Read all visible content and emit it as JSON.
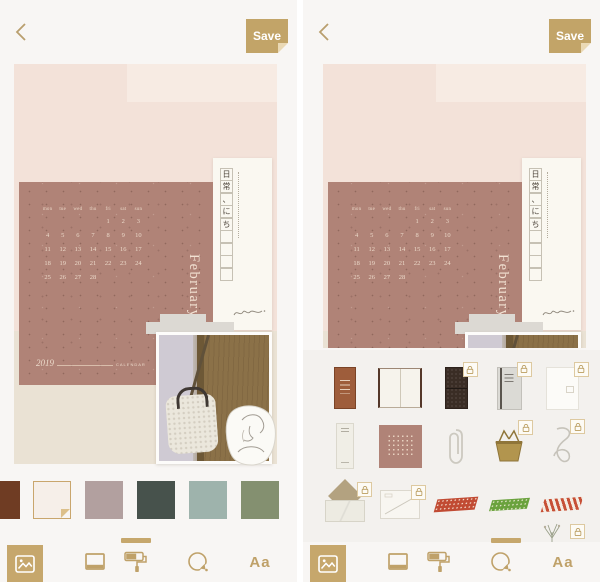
{
  "colors": {
    "accent": "#c2a468",
    "app_background": "#f8f6f4",
    "canvas_blush": "#f3e2d9",
    "canvas_cream": "#eae2d4",
    "calendar_mauve": "#b08377",
    "tray_background": "#f3f1ee"
  },
  "header": {
    "back_icon": "chevron-left",
    "save_label": "Save"
  },
  "collage": {
    "calendar": {
      "month": "February",
      "year": "2019",
      "caption": "CALENDAR",
      "day_headers": [
        "mon",
        "tue",
        "wed",
        "thu",
        "fri",
        "sat",
        "sun"
      ],
      "weeks": [
        [
          "",
          "",
          "",
          "",
          "1",
          "2",
          "3"
        ],
        [
          "4",
          "5",
          "6",
          "7",
          "8",
          "9",
          "10"
        ],
        [
          "11",
          "12",
          "13",
          "14",
          "15",
          "16",
          "17"
        ],
        [
          "18",
          "19",
          "20",
          "21",
          "22",
          "23",
          "24"
        ],
        [
          "25",
          "26",
          "27",
          "28",
          "",
          "",
          ""
        ]
      ]
    },
    "japanese_card": {
      "column_chars": [
        "日",
        "常",
        "、",
        "に",
        "ち"
      ],
      "empty_boxes": 4
    }
  },
  "left_screen": {
    "palette": {
      "swatches": [
        {
          "name": "dark-brown",
          "color": "#6f3c23",
          "selected": false
        },
        {
          "name": "cream-paper",
          "color": "#f6efe9",
          "selected": true
        },
        {
          "name": "dusty-mauve",
          "color": "#b2a09f",
          "selected": false
        },
        {
          "name": "dark-teal",
          "color": "#47524c",
          "selected": false
        },
        {
          "name": "sage-green",
          "color": "#9eb3ac",
          "selected": false
        },
        {
          "name": "olive-green",
          "color": "#849070",
          "selected": false
        }
      ]
    },
    "active_tool": "photo-tool",
    "indicator_tool": "paint-roller-tool"
  },
  "right_screen": {
    "sticker_tray": {
      "rows": [
        [
          {
            "name": "brown-notebook",
            "locked": false
          },
          {
            "name": "open-notebook",
            "locked": false
          },
          {
            "name": "dark-leather-notebook",
            "locked": true
          },
          {
            "name": "gray-notebook",
            "locked": true
          },
          {
            "name": "white-notepad",
            "locked": true
          }
        ],
        [
          {
            "name": "paper-ticket",
            "locked": false
          },
          {
            "name": "dotted-calendar-card",
            "locked": false
          },
          {
            "name": "paperclip",
            "locked": false
          },
          {
            "name": "gold-binder-clip",
            "locked": true
          },
          {
            "name": "wire-clip",
            "locked": true
          }
        ],
        [
          {
            "name": "open-envelope",
            "locked": true
          },
          {
            "name": "letter-envelope",
            "locked": true
          },
          {
            "name": "red-checked-tape",
            "locked": false,
            "color": "#c14b33"
          },
          {
            "name": "green-dotted-tape",
            "locked": false,
            "color": "#6aa23d"
          },
          {
            "name": "red-striped-tape",
            "locked": false,
            "color": "#c75036"
          }
        ]
      ],
      "partial_item": {
        "name": "dried-flower",
        "locked": true
      }
    },
    "active_tool": "photo-tool",
    "indicator_tool": "sticker-tool"
  },
  "toolbar": {
    "items": [
      {
        "name": "photo-tool",
        "icon": "image-icon",
        "active": true
      },
      {
        "name": "frame-tool",
        "icon": "frame-icon",
        "active": false
      },
      {
        "name": "paint-roller-tool",
        "icon": "paint-roller-icon",
        "active": false
      },
      {
        "name": "sticker-tool",
        "icon": "sticker-circle-icon",
        "active": false
      },
      {
        "name": "text-tool",
        "icon": "text-icon",
        "label": "Aa",
        "active": false
      }
    ]
  }
}
